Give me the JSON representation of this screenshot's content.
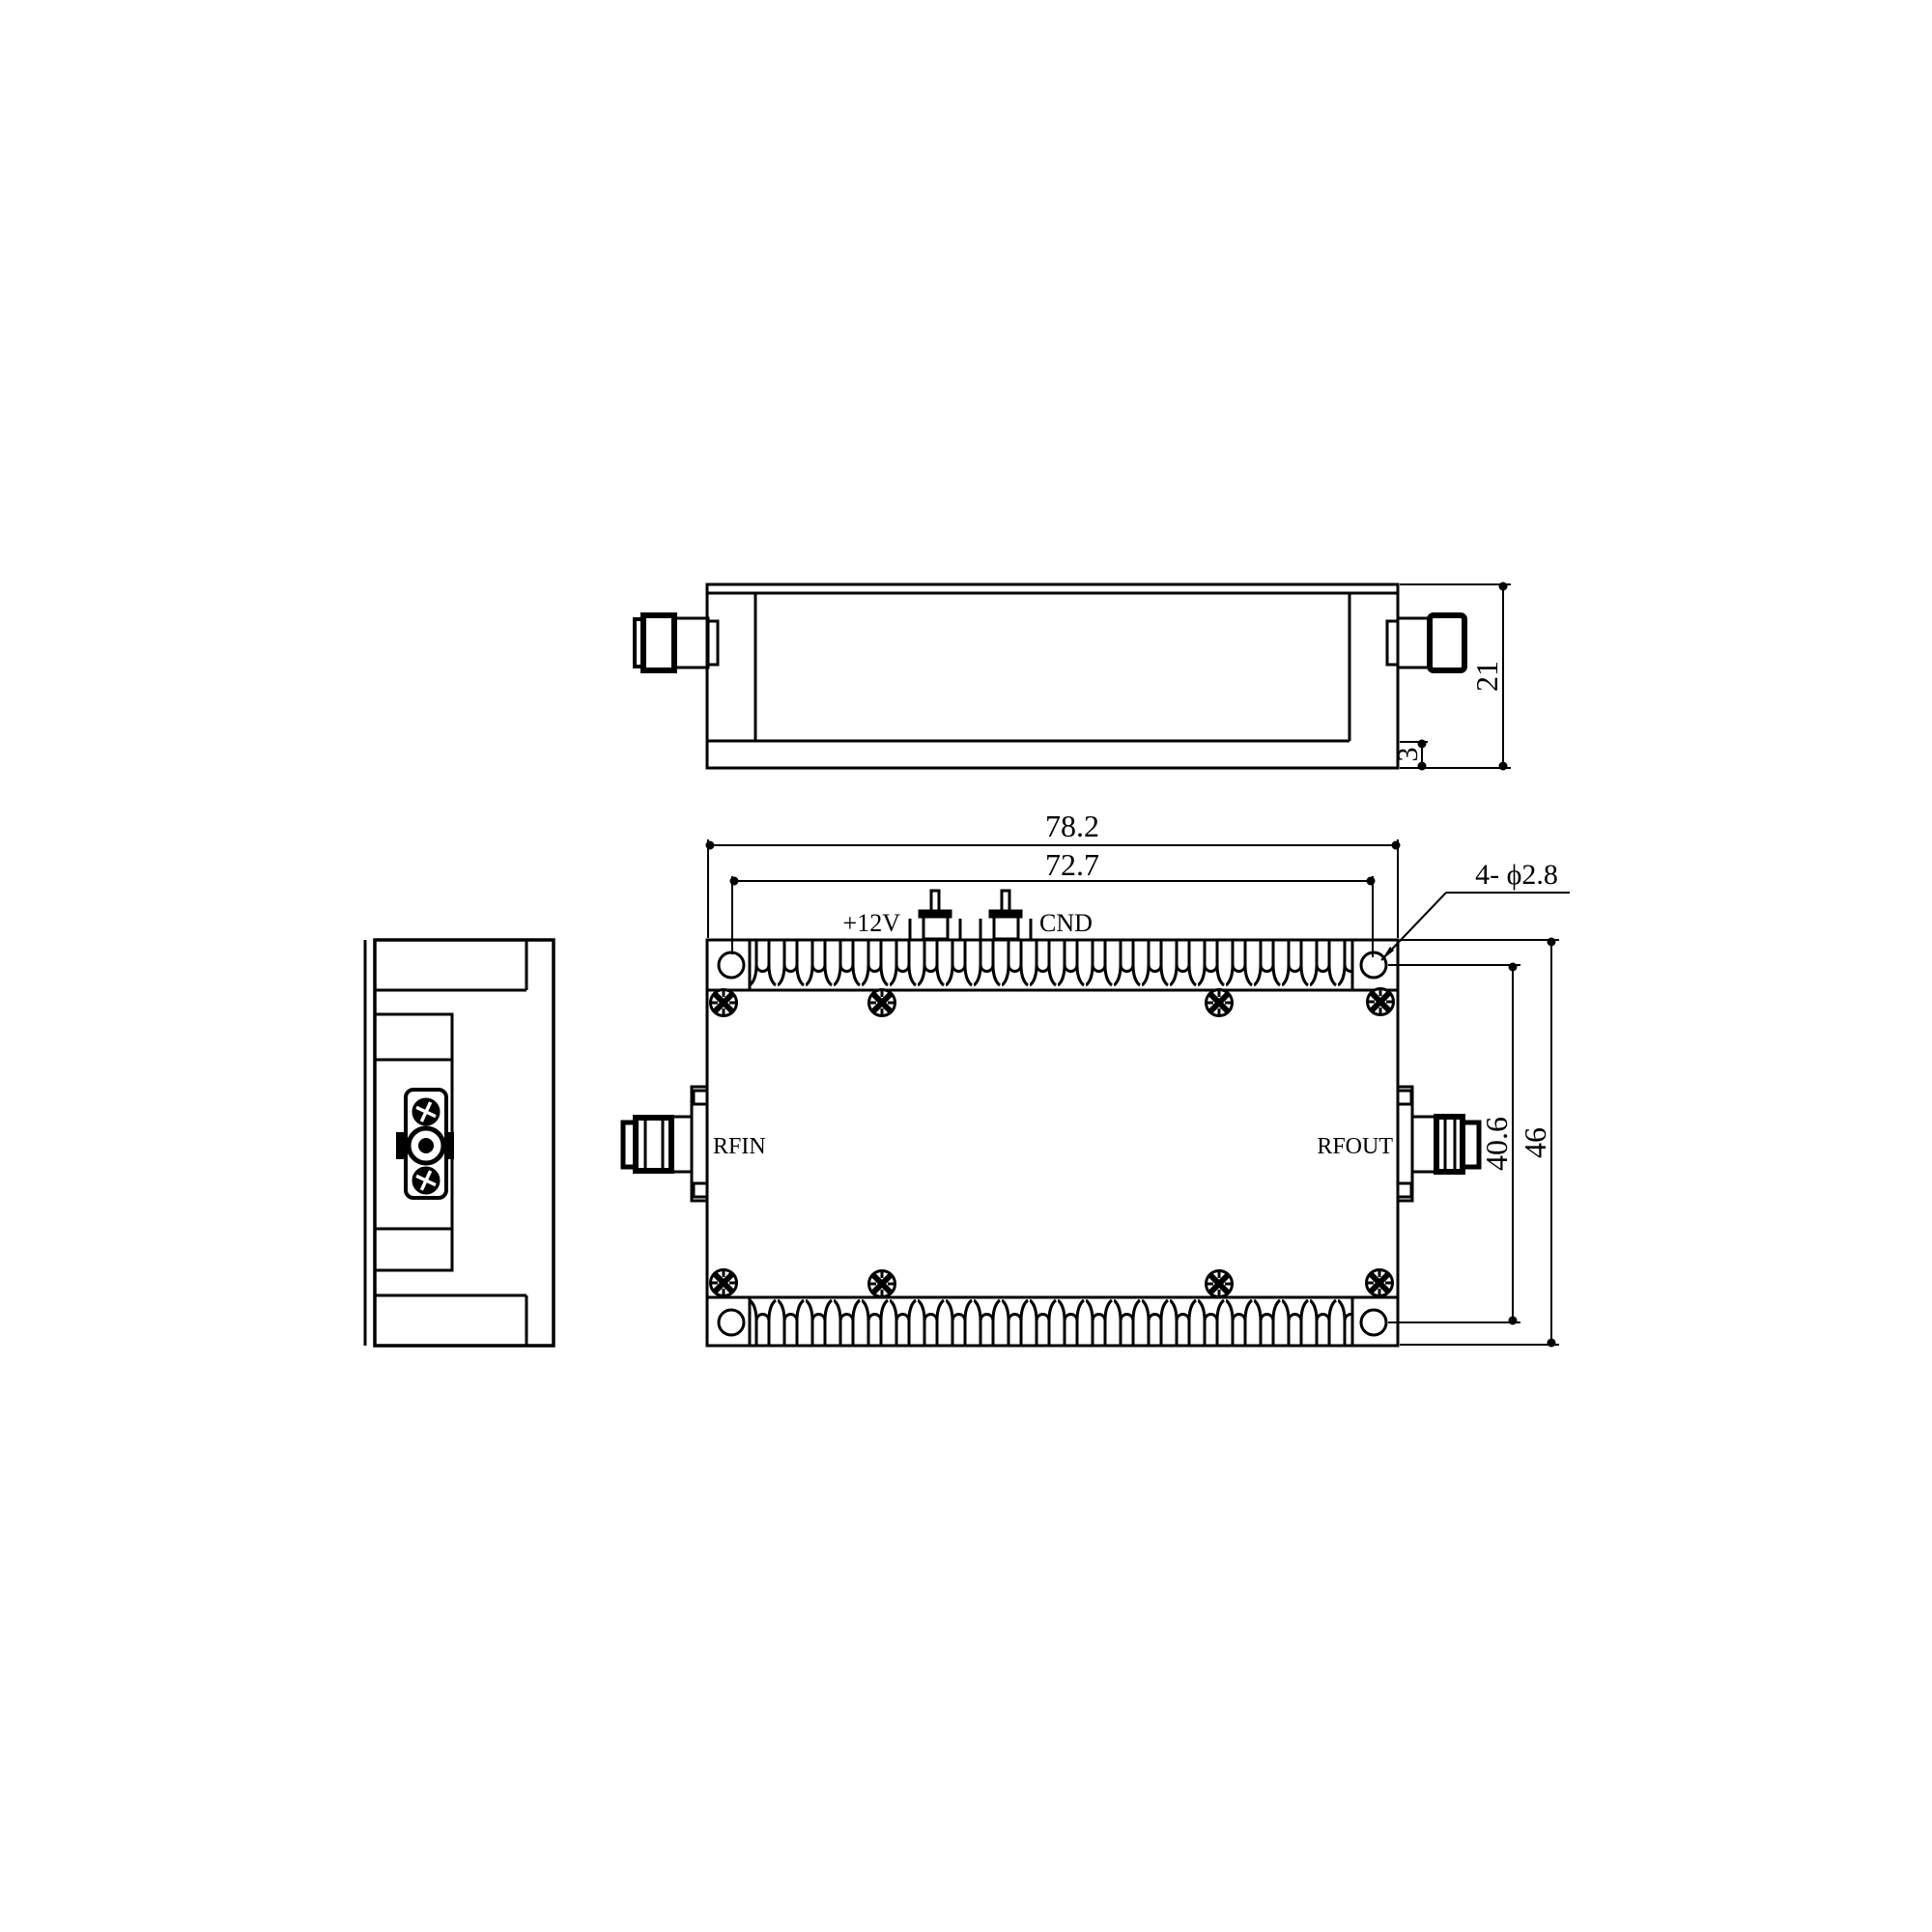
{
  "drawing": {
    "background": "#ffffff",
    "ink_color": "#000000",
    "views": [
      "side-view",
      "top-view",
      "front-view"
    ]
  },
  "top_view": {
    "dim_height": "21",
    "dim_base_thickness": "3"
  },
  "front_view": {
    "dim_width_total": "78.2",
    "dim_hole_spacing_horizontal": "72.7",
    "dim_mounting_holes": "4- ϕ2.8",
    "dim_hole_spacing_vertical": "40.6",
    "dim_height_total": "46",
    "label_rf_in": "RFIN",
    "label_rf_out": "RFOUT",
    "label_power_terminal": "+12V",
    "label_ground_terminal": "CND"
  }
}
